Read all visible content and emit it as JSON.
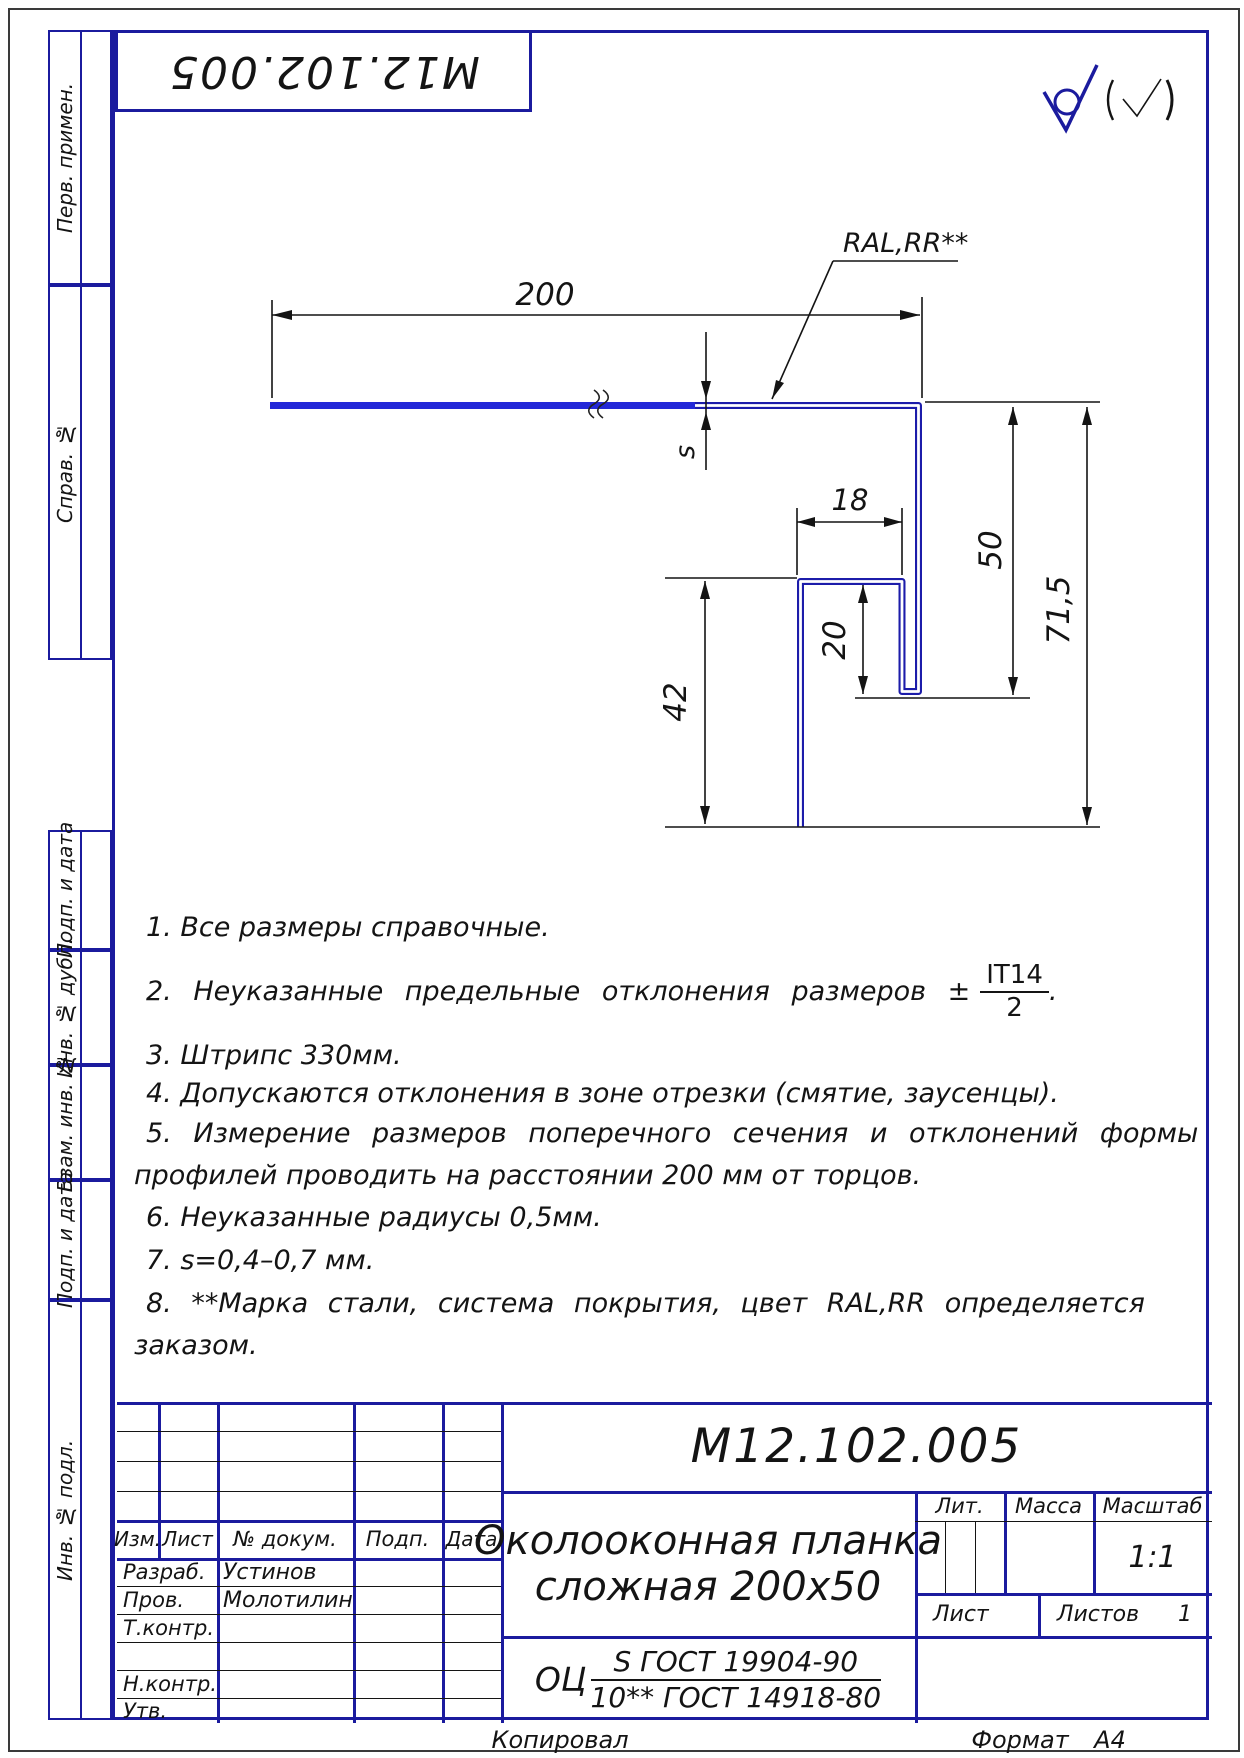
{
  "colors": {
    "frame_blue": "#1b1b9e",
    "profile_blue": "#1c1caa",
    "profile_highlight": "#2328d8",
    "line_black": "#141414"
  },
  "corner_stamp": {
    "designation": "М12.102.005"
  },
  "margin_labels": {
    "top": [
      "Перв. примен.",
      "Справ. №"
    ],
    "bottom": [
      "Подп. и дата",
      "Инв. № дубл.",
      "Взам. инв. №",
      "Подп. и дата",
      "Инв. № подл."
    ]
  },
  "roughness": {
    "mark": "(√)"
  },
  "drawing": {
    "leader_label": "RAL,RR**",
    "dims": {
      "flange_width": "200",
      "hook_width": "18",
      "wall_height": "50",
      "total_height": "71,5",
      "leg_height": "42",
      "hook_height": "20",
      "thickness": "s"
    }
  },
  "notes": {
    "n1": "1.  Все размеры справочные.",
    "n2_prefix": "2.  Неуказанные предельные отклонения размеров ±",
    "n2_frac_top": "IT14",
    "n2_frac_bottom": "2",
    "n2_suffix": ".",
    "n3": "3.  Штрипс 330мм.",
    "n4": "4.  Допускаются отклонения в зоне отрезки (смятие, заусенцы).",
    "n5_line1": "5.  Измерение размеров поперечного сечения и отклонений формы",
    "n5_line2": "профилей проводить на расстоянии 200 мм от торцов.",
    "n6": "6.  Неуказанные радиусы 0,5мм.",
    "n7": "7.  s=0,4–0,7 мм.",
    "n8_line1": "8.  **Марка стали, система покрытия, цвет RAL,RR определяется",
    "n8_line2": "заказом."
  },
  "title_block": {
    "designation": "М12.102.005",
    "name_line1": "Околооконная планка",
    "name_line2": "сложная 200х50",
    "material": {
      "prefix": "ОЦ",
      "top": "S ГОСТ 19904-90",
      "bottom": "10** ГОСТ 14918-80"
    },
    "rev_header": {
      "izm": "Изм.",
      "list": "Лист",
      "doc": "№ докум.",
      "podp": "Подп.",
      "data": "Дата"
    },
    "staff": [
      {
        "role": "Разраб.",
        "name": "Устинов"
      },
      {
        "role": "Пров.",
        "name": "Молотилин"
      },
      {
        "role": "Т.контр.",
        "name": ""
      },
      {
        "role": "",
        "name": ""
      },
      {
        "role": "Н.контр.",
        "name": ""
      },
      {
        "role": "Утв.",
        "name": ""
      }
    ],
    "lit_label": "Лит.",
    "mass_label": "Масса",
    "scale_label": "Масштаб",
    "scale_value": "1:1",
    "sheet_label": "Лист",
    "sheets_label": "Листов",
    "sheets_value": "1"
  },
  "footer": {
    "copied": "Копировал",
    "format_label": "Формат",
    "format_value": "А4"
  }
}
